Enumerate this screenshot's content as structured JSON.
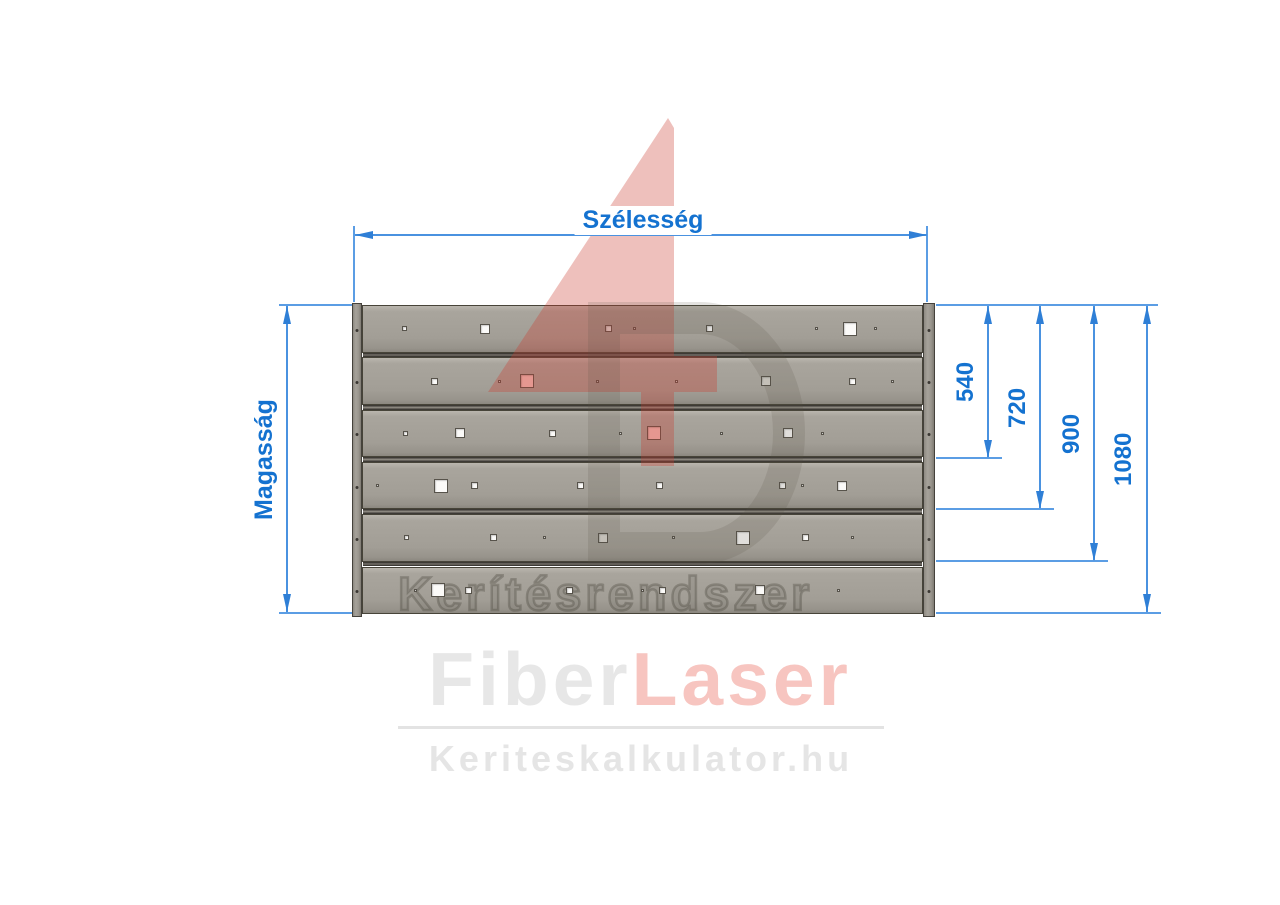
{
  "dims": {
    "width_label": "Szélesség",
    "height_label": "Magasság",
    "right_values": [
      "540",
      "720",
      "900",
      "1080"
    ]
  },
  "panel": {
    "slat_count": 6,
    "engraving": "Kerítésrendszer",
    "fastener_rows": [
      0,
      1,
      2,
      3,
      4,
      5
    ],
    "hole_sizes": {
      "dot": 3,
      "tiny": 5,
      "small": 7,
      "med": 10,
      "large": 14
    },
    "rows": [
      [
        {
          "x_pct": 7.5,
          "size": "tiny"
        },
        {
          "x_pct": 22,
          "size": "med"
        },
        {
          "x_pct": 44,
          "size": "small"
        },
        {
          "x_pct": 48.5,
          "size": "dot"
        },
        {
          "x_pct": 62,
          "size": "small"
        },
        {
          "x_pct": 81,
          "size": "dot"
        },
        {
          "x_pct": 87,
          "size": "large"
        },
        {
          "x_pct": 91.5,
          "size": "dot"
        }
      ],
      [
        {
          "x_pct": 13,
          "size": "small"
        },
        {
          "x_pct": 24.5,
          "size": "dot"
        },
        {
          "x_pct": 29.5,
          "size": "large",
          "tint": "pink"
        },
        {
          "x_pct": 42,
          "size": "dot"
        },
        {
          "x_pct": 56,
          "size": "dot"
        },
        {
          "x_pct": 72,
          "size": "med",
          "tint": "shade"
        },
        {
          "x_pct": 87.5,
          "size": "small"
        },
        {
          "x_pct": 94.5,
          "size": "dot"
        }
      ],
      [
        {
          "x_pct": 7.7,
          "size": "tiny"
        },
        {
          "x_pct": 17.5,
          "size": "med"
        },
        {
          "x_pct": 34,
          "size": "small"
        },
        {
          "x_pct": 46,
          "size": "dot"
        },
        {
          "x_pct": 52,
          "size": "large",
          "tint": "pink"
        },
        {
          "x_pct": 64,
          "size": "dot"
        },
        {
          "x_pct": 76,
          "size": "med"
        },
        {
          "x_pct": 82,
          "size": "dot"
        }
      ],
      [
        {
          "x_pct": 2.7,
          "size": "dot"
        },
        {
          "x_pct": 14,
          "size": "large"
        },
        {
          "x_pct": 20,
          "size": "small"
        },
        {
          "x_pct": 39,
          "size": "small"
        },
        {
          "x_pct": 53,
          "size": "small"
        },
        {
          "x_pct": 75,
          "size": "small"
        },
        {
          "x_pct": 78.5,
          "size": "dot"
        },
        {
          "x_pct": 85.5,
          "size": "med"
        }
      ],
      [
        {
          "x_pct": 8,
          "size": "tiny"
        },
        {
          "x_pct": 23.5,
          "size": "small"
        },
        {
          "x_pct": 32.5,
          "size": "dot"
        },
        {
          "x_pct": 43,
          "size": "med",
          "tint": "shade"
        },
        {
          "x_pct": 55.5,
          "size": "dot"
        },
        {
          "x_pct": 68,
          "size": "large"
        },
        {
          "x_pct": 79,
          "size": "small"
        },
        {
          "x_pct": 87.5,
          "size": "dot"
        }
      ],
      [
        {
          "x_pct": 9.5,
          "size": "dot"
        },
        {
          "x_pct": 13.5,
          "size": "large"
        },
        {
          "x_pct": 19,
          "size": "small"
        },
        {
          "x_pct": 37,
          "size": "small"
        },
        {
          "x_pct": 50,
          "size": "dot"
        },
        {
          "x_pct": 53.5,
          "size": "small"
        },
        {
          "x_pct": 71,
          "size": "med"
        },
        {
          "x_pct": 85,
          "size": "dot"
        }
      ]
    ]
  },
  "watermark": {
    "logo": "4D"
  },
  "brand": {
    "name_first": "Fiber",
    "name_second": "Laser",
    "url": "Keriteskalkulator.hu"
  },
  "colors": {
    "dimension_line": "#4a92e0",
    "dimension_text": "#1472d0",
    "slat_gray": "#a29e96",
    "watermark_red": "rgba(202,58,46,0.32)",
    "watermark_gray": "rgba(85,79,71,0.16)",
    "brand_gray": "#e7e7e7",
    "brand_red": "#f7c5c0"
  }
}
